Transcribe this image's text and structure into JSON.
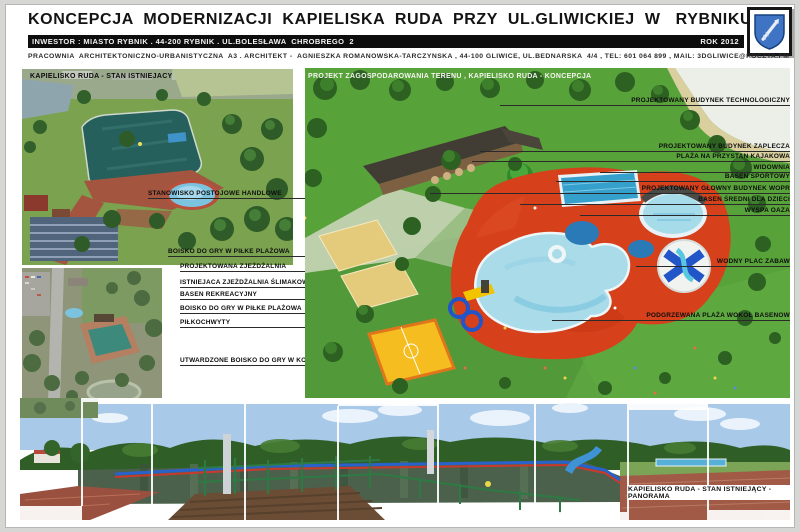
{
  "header": {
    "title": "KONCEPCJA  MODERNIZACJI  KAPIELISKA  RUDA  PRZY  UL.GLIWICKIEJ  W   RYBNIKU",
    "investor_line": "INWESTOR : MIASTO RYBNIK . 44-200 RYBNIK . UL.BOLESŁAWA  CHROBREGO  2",
    "year": "ROK 2012",
    "studio_line": "PRACOWNIA  ARCHITEKTONICZNO-URBANISTYCZNA  A3 . ARCHITEKT -  AGNIESZKA ROMANOWSKA-TARCZYNSKA , 44-100 GLIWICE, UL.BEDNARSKA  4/4 , TEL: 601 064 899 , MAIL: 3DGLIWICE@POCZTA.FM",
    "crest_name": "rybnik-coat-of-arms"
  },
  "left_panel": {
    "aerial_photo_label": "KAPIELISKO RUDA - STAN ISTNIEJACY",
    "photo_callouts": [
      "STANOWISKO POSTOJOWE HANDLOWE",
      "BOISKO DO GRY W PIŁKE PLAŻOWA"
    ],
    "callouts": [
      "PROJEKTOWANA ZJEŻDŻALNIA",
      "ISTNIEJACA ZJEŻDŻALNIA ŚLIMAKOWA",
      "BASEN REKREACYJNY",
      "BOISKO DO GRY W PIŁKE PLAŻOWA",
      "PIŁKOCHWYTY",
      "UTWARDZONE BOISKO DO GRY W KOSZYKÓWKE"
    ]
  },
  "main_render": {
    "title": "PROJEKT ZAGOSPODAROWANIA TERENU , KAPIELISKO RUDA - KONCEPCJA",
    "right_callouts": [
      "PROJEKTOWANY BUDYNEK TECHNOLOGICZNY",
      "PROJEKTOWANY BUDYNEK ZAPLECZA",
      "PLAŻA NA PRZYSTAN KAJAKOWA",
      "WIDOWNIA",
      "BASEN SPORTOWY",
      "PROJEKTOWANY GŁOWNY BUDYNEK WOPR",
      "BASEN ŚREDNI DLA DZIECI",
      "WYSPA OAZA",
      "WODNY PLAC ZABAW",
      "PODGRZEWANA PLAŻA WOKOŁ BASENOW"
    ]
  },
  "panorama": {
    "label": "KAPIELISKO RUDA - STAN ISTNIEJĄCY - PANORAMA"
  },
  "colors": {
    "deck_orange": "#d6401a",
    "pool_light_blue": "#a9dbe9",
    "sport_pool_blue": "#35a0cc",
    "lawn_green": "#58a23a",
    "crest_blue": "#3f74c4",
    "bar_black": "#0d0d0d"
  }
}
